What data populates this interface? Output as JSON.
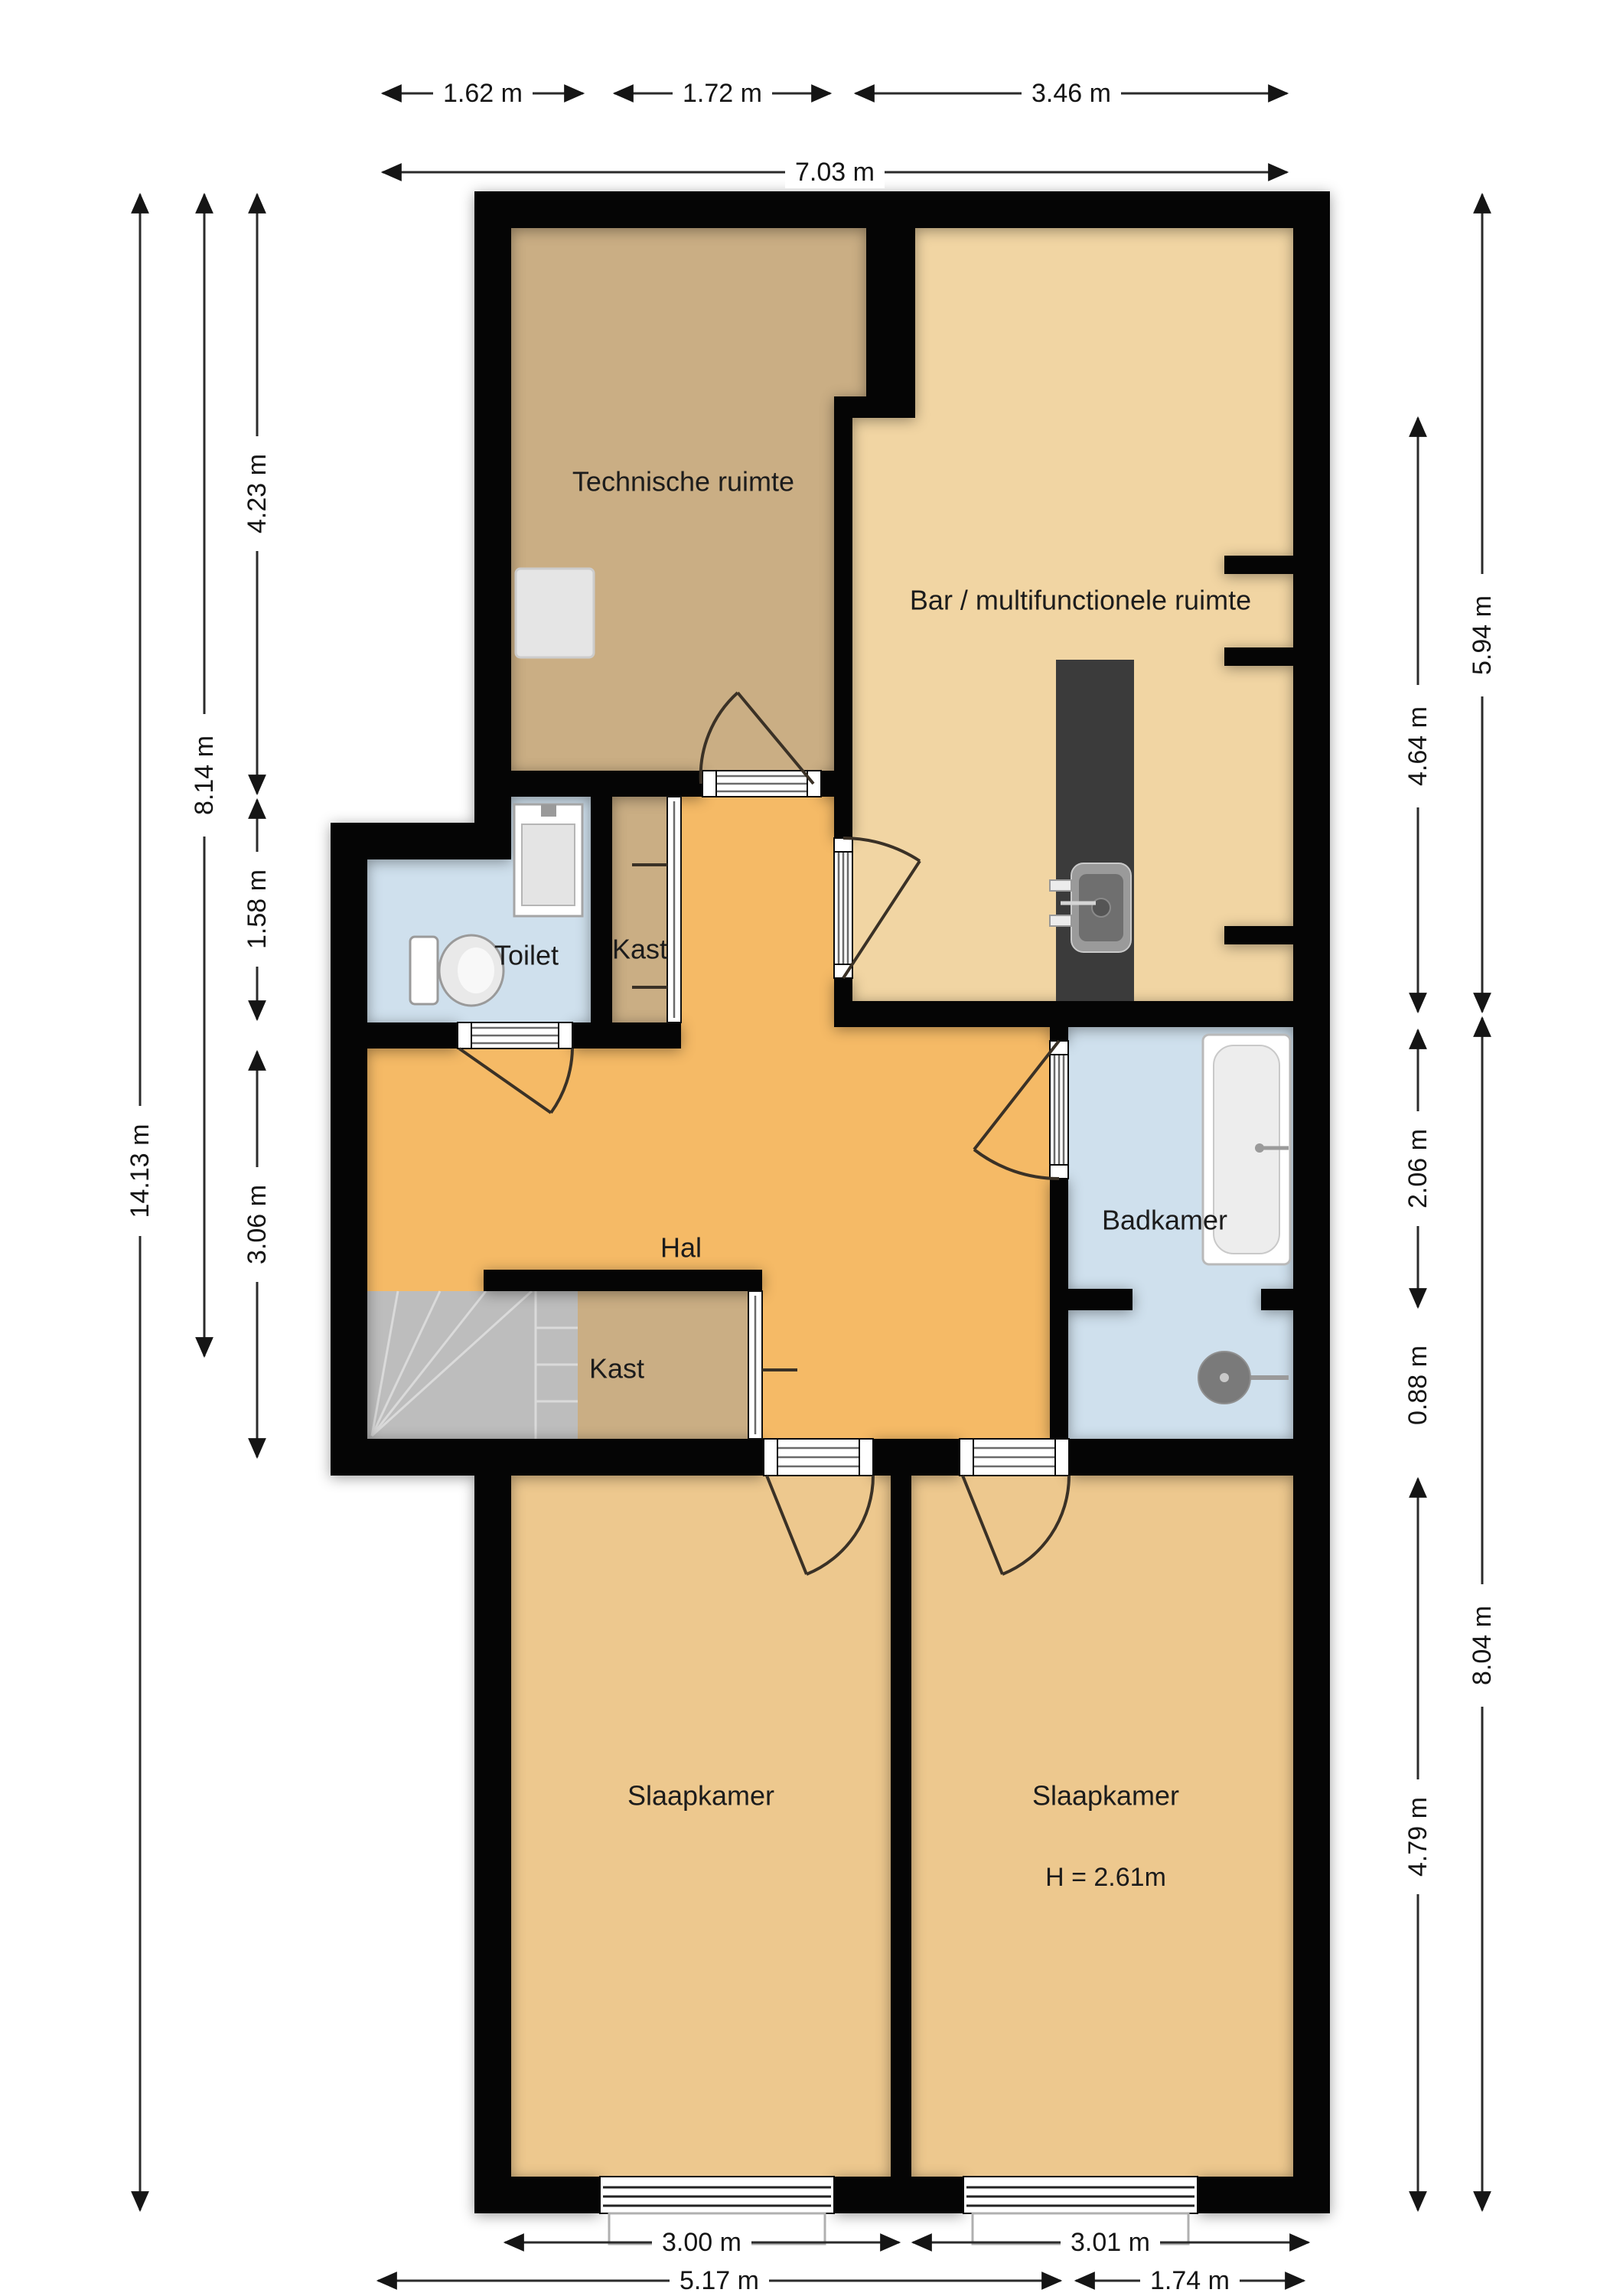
{
  "rooms": {
    "technische": {
      "label": "Technische ruimte",
      "fill": "#caae84"
    },
    "bar": {
      "label": "Bar / multifunctionele ruimte",
      "fill": "#f1d5a3"
    },
    "toilet": {
      "label": "Toilet",
      "fill": "#cfe0ed"
    },
    "kast1": {
      "label": "Kast",
      "fill": "#caae84"
    },
    "hal": {
      "label": "Hal",
      "fill": "#f5ba66"
    },
    "badkamer": {
      "label": "Badkamer",
      "fill": "#cfe0ed"
    },
    "kast2": {
      "label": "Kast",
      "fill": "#caae84"
    },
    "slaapkamer1": {
      "label": "Slaapkamer",
      "fill": "#edc88e"
    },
    "slaapkamer2": {
      "label": "Slaapkamer",
      "height_note": "H = 2.61m",
      "fill": "#edc88e"
    }
  },
  "dimensions": {
    "top": [
      {
        "label": "1.62 m"
      },
      {
        "label": "1.72 m"
      },
      {
        "label": "3.46 m"
      },
      {
        "label": "7.03 m"
      }
    ],
    "bottom": [
      {
        "label": "3.00 m"
      },
      {
        "label": "3.01 m"
      },
      {
        "label": "5.17 m"
      },
      {
        "label": "1.74 m"
      }
    ],
    "left": [
      {
        "label": "14.13 m"
      },
      {
        "label": "8.14 m"
      },
      {
        "label": "4.23 m"
      },
      {
        "label": "1.58 m"
      },
      {
        "label": "3.06 m"
      }
    ],
    "right": [
      {
        "label": "5.94 m"
      },
      {
        "label": "8.04 m"
      },
      {
        "label": "4.64 m"
      },
      {
        "label": "2.06 m"
      },
      {
        "label": "0.88 m"
      },
      {
        "label": "4.79 m"
      }
    ]
  },
  "colors": {
    "wall": "#050505",
    "stairs": "#bdbdbd",
    "counter": "#3b3b3b",
    "fixture_fill": "#e9e9e9",
    "bath_blue": "#cfe0ed",
    "hal_orange": "#f5ba66"
  }
}
